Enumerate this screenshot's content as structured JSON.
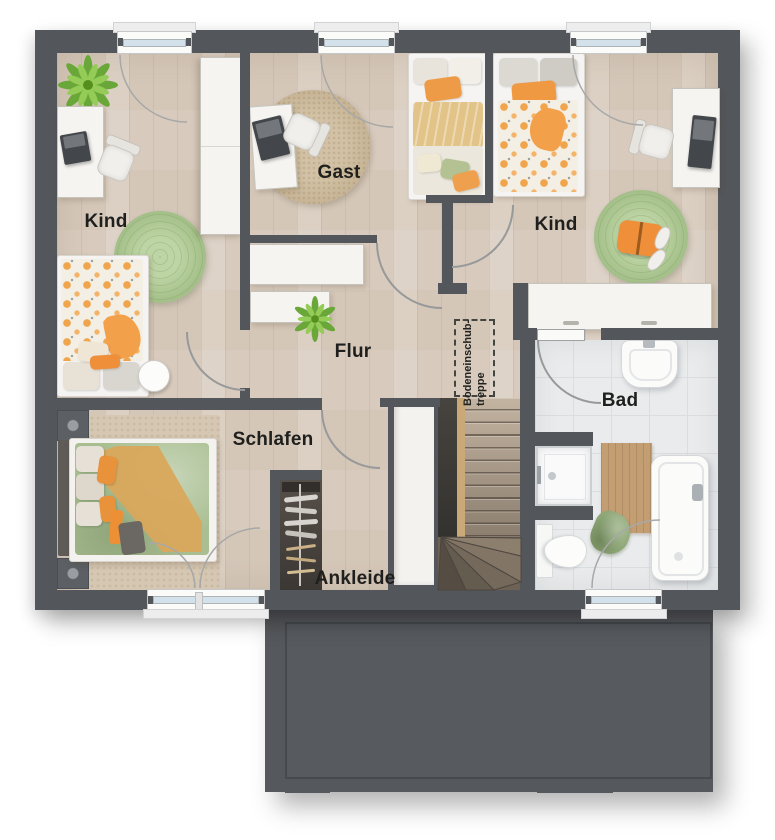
{
  "floorplan": {
    "rooms": {
      "kind_left": {
        "label": "Kind"
      },
      "gast": {
        "label": "Gast"
      },
      "kind_right": {
        "label": "Kind"
      },
      "flur": {
        "label": "Flur"
      },
      "schlafen": {
        "label": "Schlafen"
      },
      "ankleide": {
        "label": "Ankleide"
      },
      "bad": {
        "label": "Bad"
      }
    },
    "annotations": {
      "attic_ladder": {
        "line1": "Bodeneinschub-",
        "line2": "treppe"
      }
    },
    "colors": {
      "wall": "#53565a",
      "wood_floor": "#d8cbbd",
      "bath_tile": "#e9ebec",
      "stair_wood": "#b0a08e",
      "annex_roof": "#55585c",
      "accent_orange": "#ef9a43",
      "rug_green": "#a9c48e",
      "rug_beige": "#c9b697",
      "duvet_sage": "#a9bf92",
      "throw_mustard": "#d9a85c",
      "plant_green": "#6fae3f"
    }
  }
}
